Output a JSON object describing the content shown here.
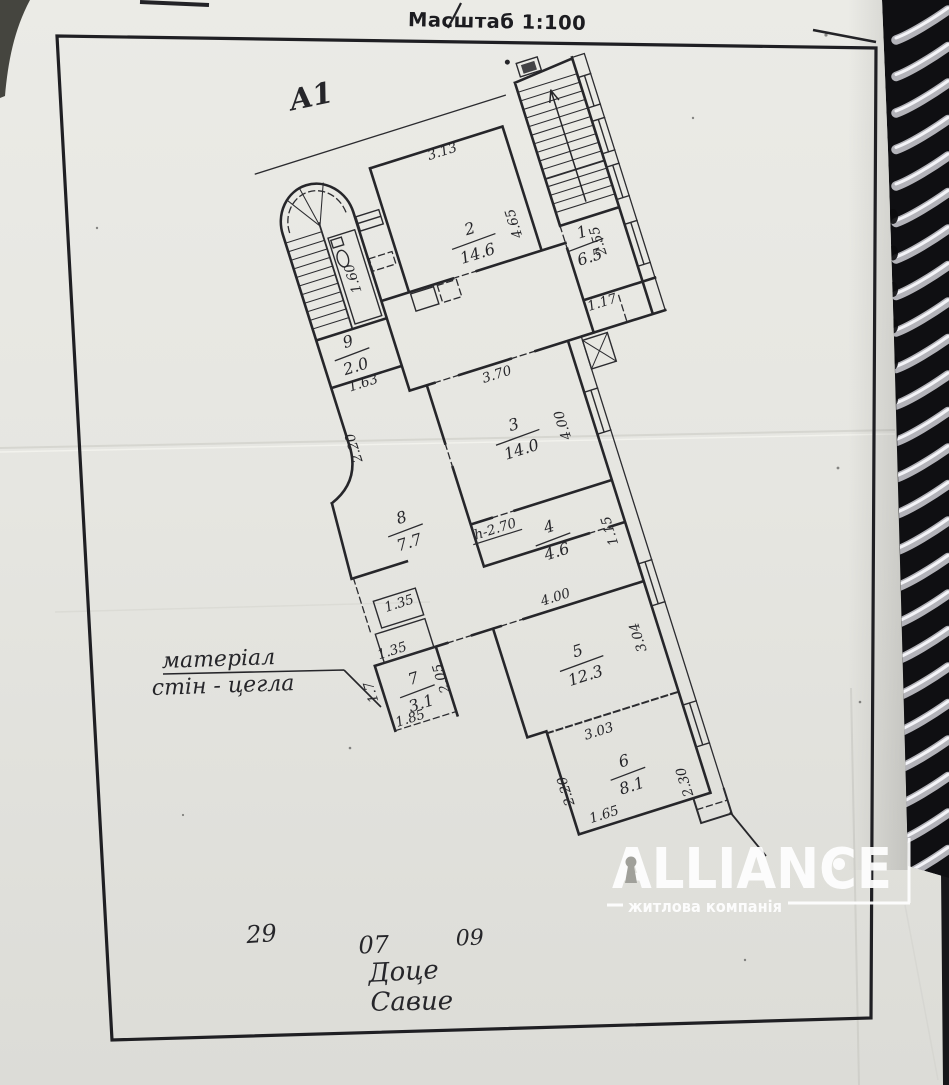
{
  "document": {
    "scale_label": "Масштаб 1:100",
    "sheet_mark": "А1",
    "material_note": {
      "line1": "матеріал",
      "line2": "стін - цегла"
    },
    "date": {
      "day": "29",
      "month": "07",
      "year": "09"
    },
    "signature": {
      "line1": "Доце",
      "line2": "Савие"
    }
  },
  "plan": {
    "rooms": [
      {
        "number": "1",
        "area": "6.5",
        "x": 624,
        "y": 305
      },
      {
        "number": "2",
        "area": "14.6",
        "x": 518,
        "y": 268
      },
      {
        "number": "3",
        "area": "14.0",
        "x": 501,
        "y": 468
      },
      {
        "number": "4",
        "area": "4.6",
        "x": 504,
        "y": 576
      },
      {
        "number": "5",
        "area": "12.3",
        "x": 494,
        "y": 703
      },
      {
        "number": "6",
        "area": "8.1",
        "x": 505,
        "y": 822
      },
      {
        "number": "7",
        "area": "3.1",
        "x": 329,
        "y": 680
      },
      {
        "number": "8",
        "area": "7.7",
        "x": 366,
        "y": 523
      },
      {
        "number": "9",
        "area": "2.0",
        "x": 368,
        "y": 339
      }
    ],
    "dimensions": [
      {
        "v": "3.13",
        "x": 515,
        "y": 180,
        "r": 0
      },
      {
        "v": "4.65",
        "x": 566,
        "y": 266,
        "r": -90
      },
      {
        "v": "1.60",
        "x": 396,
        "y": 270,
        "r": -90
      },
      {
        "v": "2.55",
        "x": 641,
        "y": 308,
        "r": -90
      },
      {
        "v": "1.17",
        "x": 622,
        "y": 372,
        "r": 0
      },
      {
        "v": "1.63",
        "x": 370,
        "y": 377,
        "r": 0
      },
      {
        "v": "3.70",
        "x": 500,
        "y": 409,
        "r": 0
      },
      {
        "v": "4.00",
        "x": 552,
        "y": 473,
        "r": -90
      },
      {
        "v": "2.20",
        "x": 346,
        "y": 432,
        "r": -90
      },
      {
        "v": "h-2.70",
        "x": 452,
        "y": 556,
        "r": 0,
        "u": 1
      },
      {
        "v": "1.15",
        "x": 565,
        "y": 588,
        "r": -90
      },
      {
        "v": "1.35",
        "x": 338,
        "y": 598,
        "r": 0
      },
      {
        "v": "1.35",
        "x": 317,
        "y": 641,
        "r": 0
      },
      {
        "v": "1.7",
        "x": 289,
        "y": 670,
        "r": -90
      },
      {
        "v": "2.05",
        "x": 360,
        "y": 678,
        "r": -90
      },
      {
        "v": "1.85",
        "x": 314,
        "y": 711,
        "r": 0
      },
      {
        "v": "4.00",
        "x": 489,
        "y": 639,
        "r": 0
      },
      {
        "v": "3.04",
        "x": 560,
        "y": 698,
        "r": -90
      },
      {
        "v": "3.03",
        "x": 490,
        "y": 780,
        "r": 0
      },
      {
        "v": "2.20",
        "x": 445,
        "y": 823,
        "r": -90
      },
      {
        "v": "1.65",
        "x": 470,
        "y": 861,
        "r": 0
      },
      {
        "v": "2.30",
        "x": 561,
        "y": 850,
        "r": -90
      }
    ]
  },
  "logo": {
    "brand": "ALLIANCE",
    "subtitle": "житлова компанія"
  },
  "colors": {
    "ink": "#2b2b2f",
    "paper": "#e9e9e4",
    "logo": "#ffffff"
  }
}
